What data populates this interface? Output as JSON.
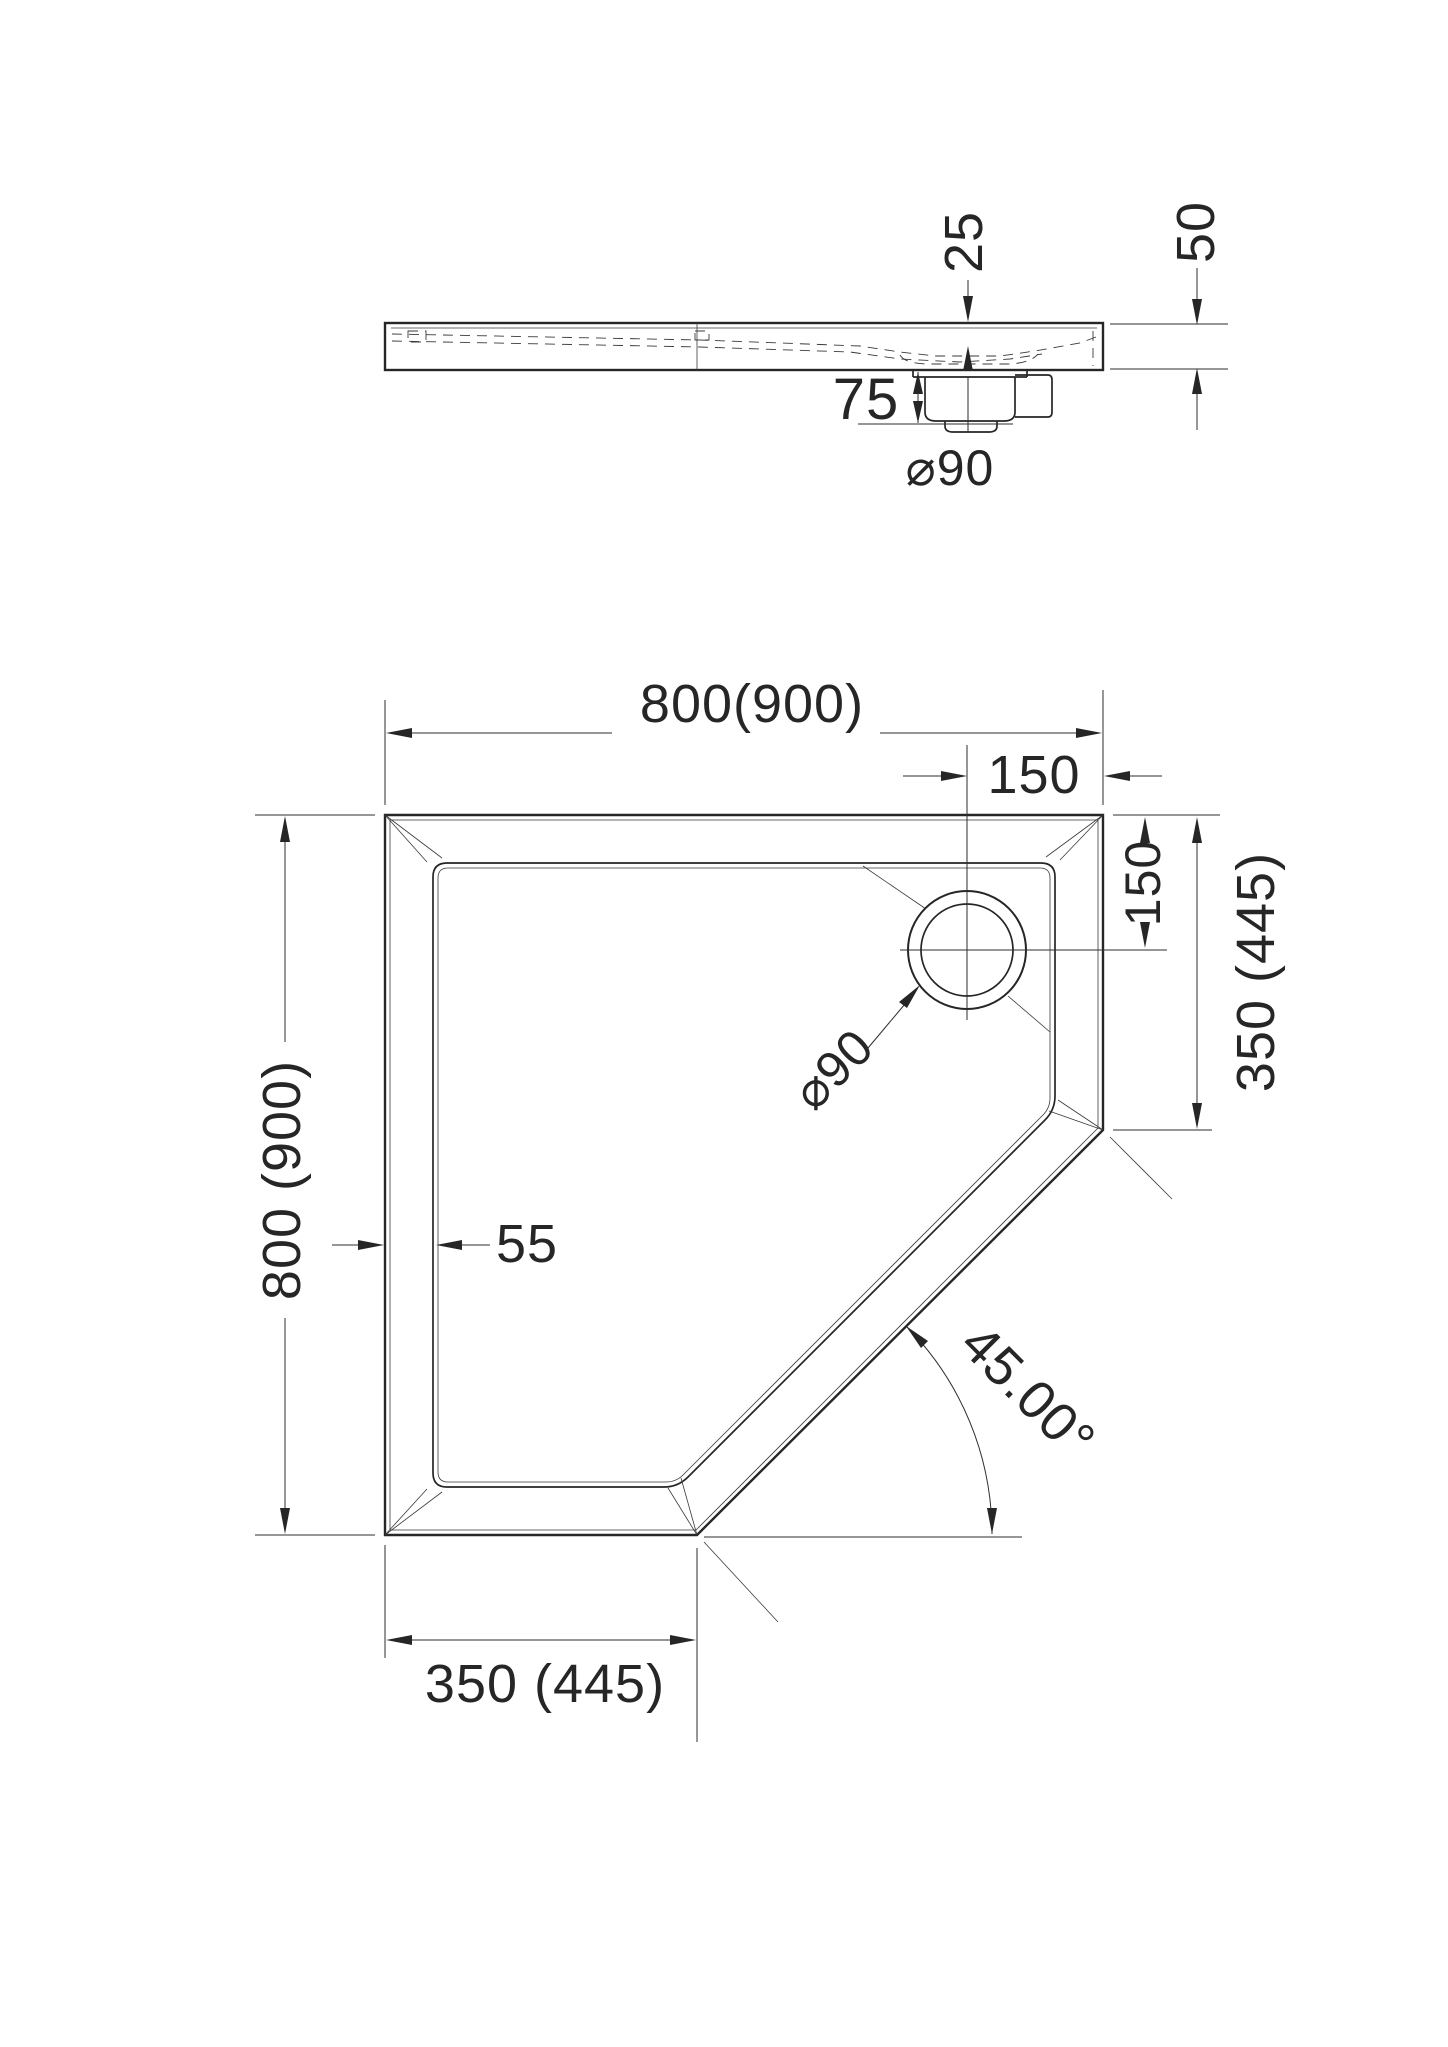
{
  "drawing": {
    "type": "technical-drawing",
    "subject": "pentagonal corner shower tray, plan and section views"
  },
  "colors": {
    "line": "#262626",
    "background": "#ffffff"
  },
  "side_view": {
    "dim_depth": "25",
    "dim_height": "50",
    "dim_trap_height": "75",
    "dim_drain": "⌀90"
  },
  "plan_view": {
    "dim_width_top": "800(900)",
    "dim_drain_offset_x": "150",
    "dim_height_left": "800 (900)",
    "dim_rim_width": "55",
    "dim_drain_offset_y": "150",
    "dim_side_right": "350 (445)",
    "dim_side_bottom": "350 (445)",
    "dim_drain": "⌀90",
    "dim_corner_angle": "45.00°"
  }
}
